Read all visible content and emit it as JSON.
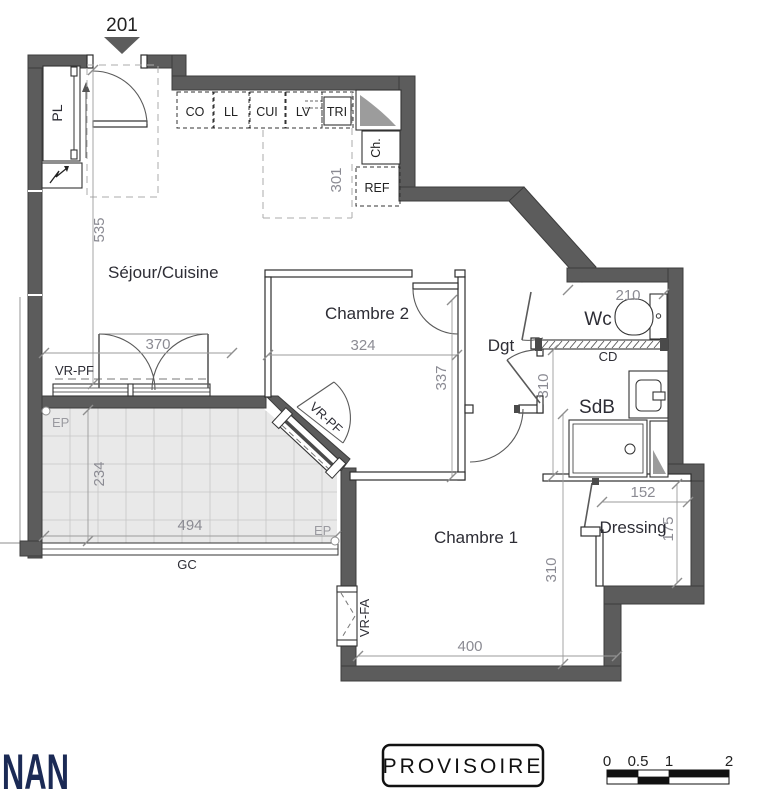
{
  "title": {
    "unit": "201"
  },
  "rooms": {
    "sejour": "Séjour/Cuisine",
    "chambre2": "Chambre 2",
    "chambre1": "Chambre 1",
    "wc": "Wc",
    "sdb": "SdB",
    "dressing": "Dressing",
    "dgt": "Dgt",
    "pl": "PL"
  },
  "kitchen": {
    "co": "CO",
    "ll": "LL",
    "cui": "CUI",
    "lv": "LV",
    "tri": "TRI",
    "ch": "Ch.",
    "ref": "REF"
  },
  "dimensions_cm": {
    "entry_wall": "535",
    "kitchen_depth": "301",
    "sejour_window": "370",
    "chambre2_width": "324",
    "chambre2_depth": "337",
    "balcony_depth": "234",
    "balcony_width": "494",
    "chambre1_width": "400",
    "chambre1_depth": "310",
    "sdb_depth": "310",
    "wc_width": "210",
    "dressing_width": "152",
    "dressing_depth": "175"
  },
  "annotations": {
    "vr_pf_sejour": "VR-PF",
    "vr_pf_chambre2": "VR-PF",
    "vr_fa": "VR-FA",
    "ep_left": "EP",
    "ep_right": "EP",
    "gc": "GC",
    "cd": "CD"
  },
  "footer": {
    "logo": "NAN",
    "stamp": "PROVISOIRE",
    "scale": {
      "t0": "0",
      "t1": "0.5",
      "t2": "1",
      "t3": "2"
    }
  },
  "colors": {
    "wall": "#5c5c5c",
    "balcony_fill": "#e9e9e9",
    "dim_text": "#8b8b93",
    "label_text": "#2d2d35",
    "logo": "#1b2a55"
  }
}
